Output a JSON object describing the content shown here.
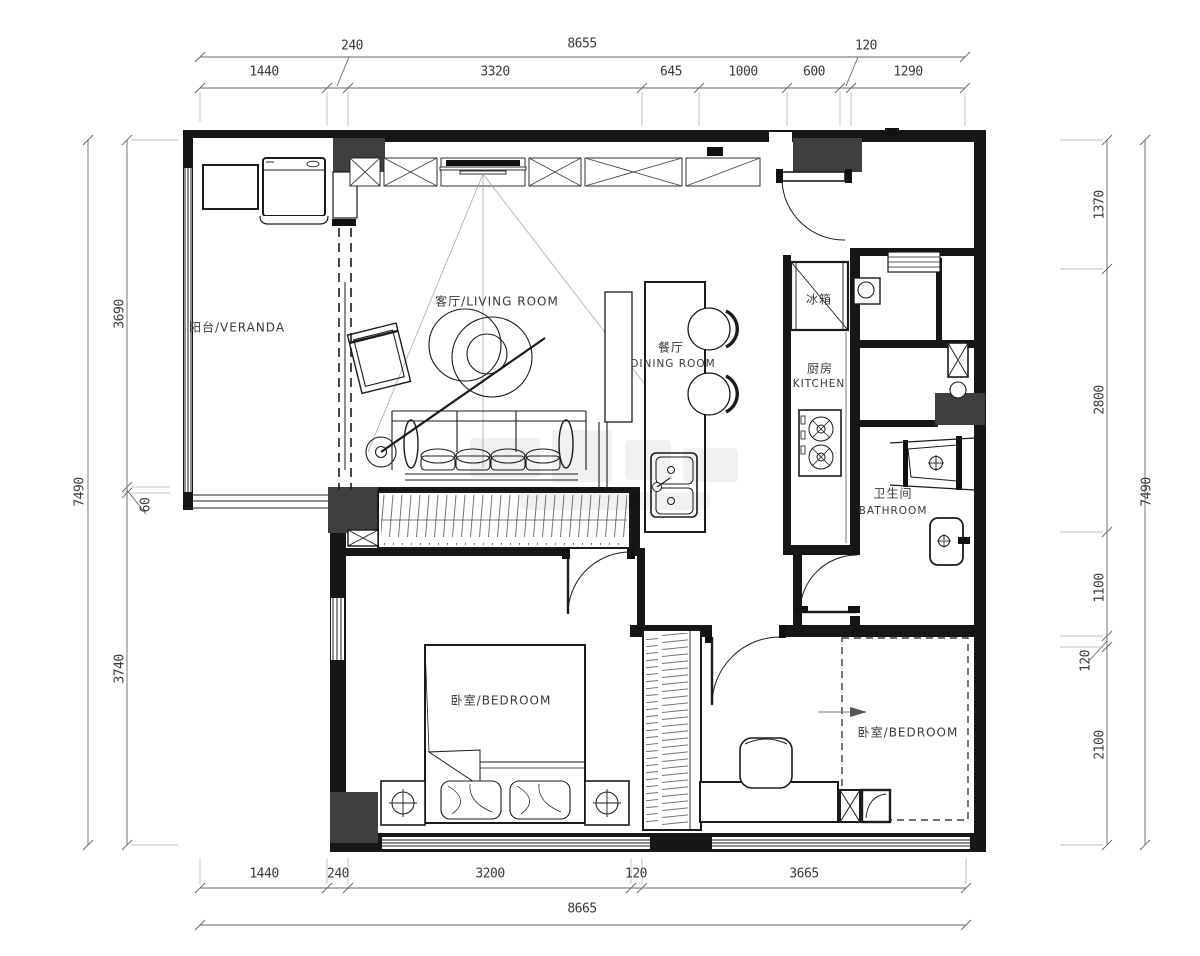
{
  "title": "apartment-floor-plan",
  "colors": {
    "line": "#1b1b1b",
    "column": "#3f3f3f",
    "dim_line": "#666666"
  },
  "dims": {
    "top_overall": "8655",
    "top_segments": [
      "1440",
      "240",
      "3320",
      "645",
      "1000",
      "600",
      "120",
      "1290"
    ],
    "bottom_segments": [
      "1440",
      "240",
      "3200",
      "120",
      "3665"
    ],
    "bottom_overall": "8665",
    "left_segments": [
      "3690",
      "60",
      "3740"
    ],
    "left_overall": "7490",
    "right_segments": [
      "1370",
      "2800",
      "1100",
      "120",
      "2100"
    ],
    "right_overall": "7490"
  },
  "labels": {
    "veranda": "阳台/VERANDA",
    "living": "客厅/LIVING ROOM",
    "dining_cn": "餐厅",
    "dining_en": "DINING ROOM",
    "fridge": "冰箱",
    "kitchen_cn": "厨房",
    "kitchen_en": "KITCHEN",
    "bathroom_cn": "卫生间",
    "bathroom_en": "BATHROOM",
    "bedroom_left": "卧室/BEDROOM",
    "bedroom_right": "卧室/BEDROOM"
  }
}
